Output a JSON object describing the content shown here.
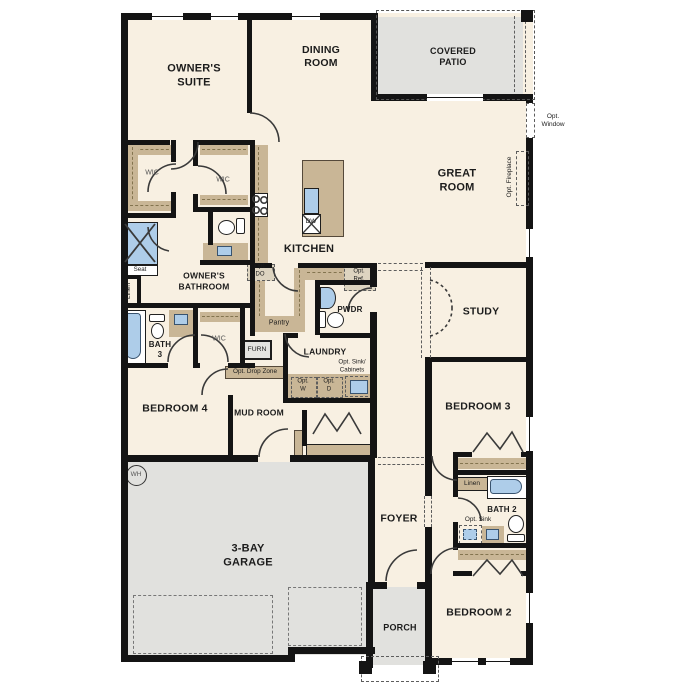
{
  "colors": {
    "wall": "#141414",
    "floor": "#f8f0e2",
    "outdoor": "#e1e1de",
    "cabinet": "#c9b696",
    "fixture_blue": "#aecde9",
    "dashed_optional": "#5d5d5d"
  },
  "rooms": {
    "owners_suite": "OWNER'S\nSUITE",
    "dining": "DINING\nROOM",
    "covered_patio": "COVERED\nPATIO",
    "great_room": "GREAT\nROOM",
    "kitchen": "KITCHEN",
    "study": "STUDY",
    "owners_bathroom": "OWNER'S\nBATHROOM",
    "bath3": "BATH\n3",
    "bedroom4": "BEDROOM 4",
    "mud_room": "MUD ROOM",
    "laundry": "LAUNDRY",
    "pwdr": "PWDR",
    "pantry": "Pantry",
    "bedroom3": "BEDROOM 3",
    "bath2": "BATH 2",
    "foyer": "FOYER",
    "garage": "3-BAY\nGARAGE",
    "porch": "PORCH",
    "bedroom2": "BEDROOM 2"
  },
  "closets": {
    "wic": "WIC",
    "linen": "Linen",
    "seat": "Seat"
  },
  "fixtures": {
    "furnace": "FURN",
    "dishwasher": "DW",
    "water_heater": "WH"
  },
  "options": {
    "window": "Opt.\nWindow",
    "fireplace": "Opt. Fireplace",
    "double_oven": "Opt.\nDO",
    "refrigerator": "Opt.\nRef.",
    "drop_zone": "Opt. Drop Zone",
    "sink_cabinets": "Opt. Sink/\nCabinets",
    "washer": "Opt.\nW",
    "dryer": "Opt.\nD",
    "sink": "Opt. Sink"
  }
}
